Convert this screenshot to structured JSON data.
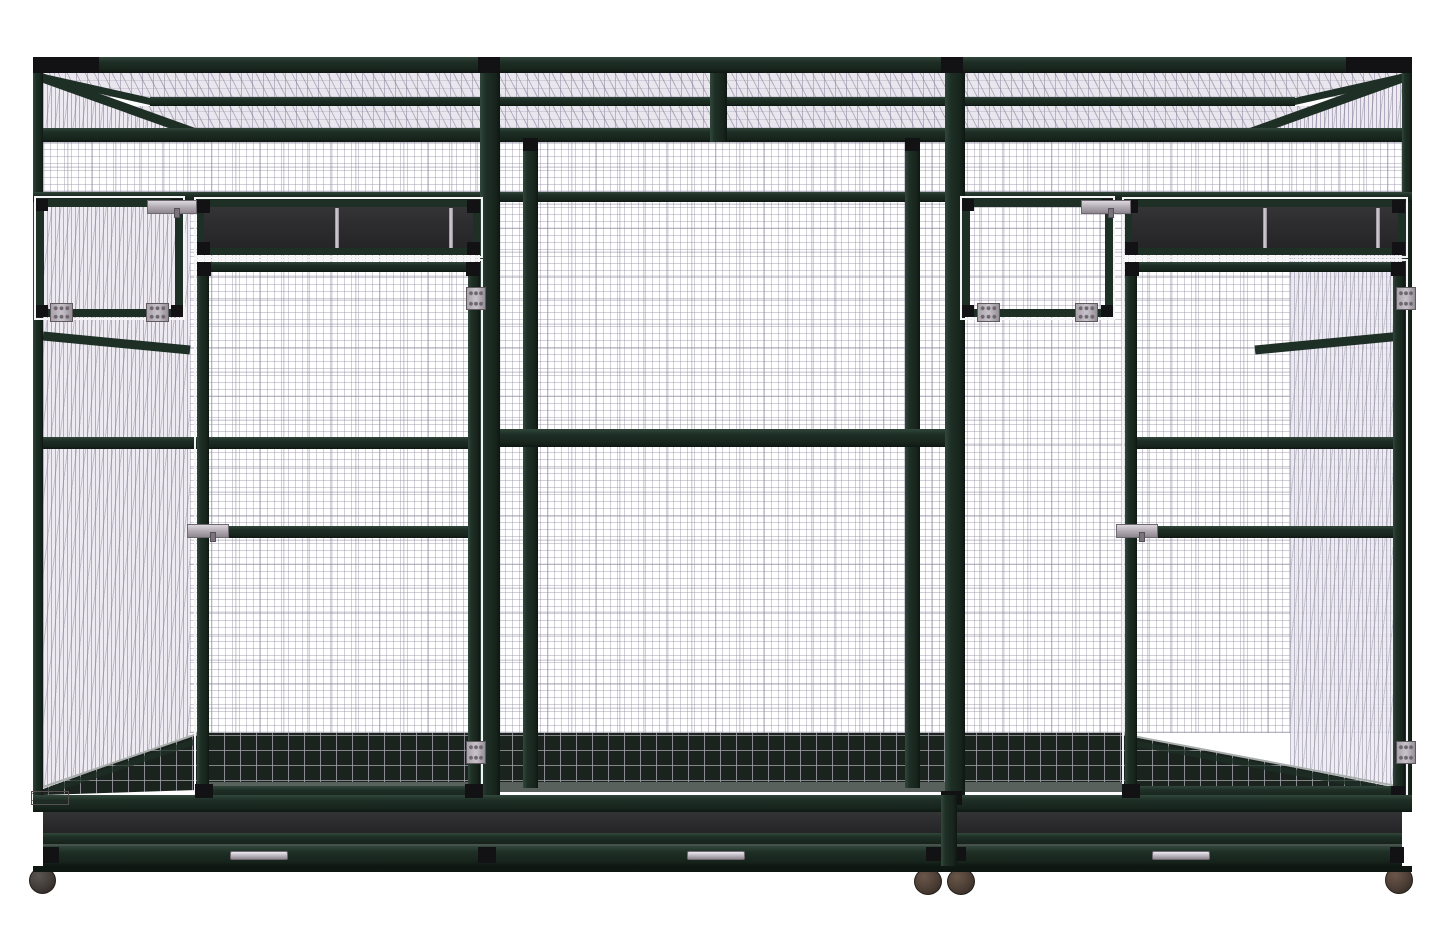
{
  "subject": "Walk-in double flight aviary bird cage with wire mesh panels, front elevation product render",
  "colors": {
    "background": "#ffffff",
    "frame_green": "#1e2f26",
    "frame_green_dark": "#142019",
    "black_block": "#121214",
    "band_charcoal": "#2d2d2f",
    "ceiling_mesh_bg": "#e9e6ee",
    "side_mesh_bg": "#edebf1",
    "floor_dark": "#1a231d",
    "floor_strip_grey": "#59615c",
    "floor_line": "#a8aeac",
    "mesh_line": "#b3aec0",
    "hardware_grey": "#b6afb7",
    "hardware_grey_dark": "#8e8790",
    "hardware_highlight": "#dcd7de",
    "caster_brown": "#4c3e35",
    "caster_dark": "#413b38",
    "white_outline": "#f4f3f6"
  },
  "inventory": {
    "sections": 3,
    "large_front_doors": 3,
    "small_feeder_doors": 2,
    "dark_panel_bands": 2,
    "metal_strips_per_band": 2,
    "door_latches": 4,
    "hinge_plates": 8,
    "pullout_tray_handles": 3,
    "casters": 4,
    "nameplate": {
      "position": "bottom-left",
      "text_legible": false
    }
  }
}
